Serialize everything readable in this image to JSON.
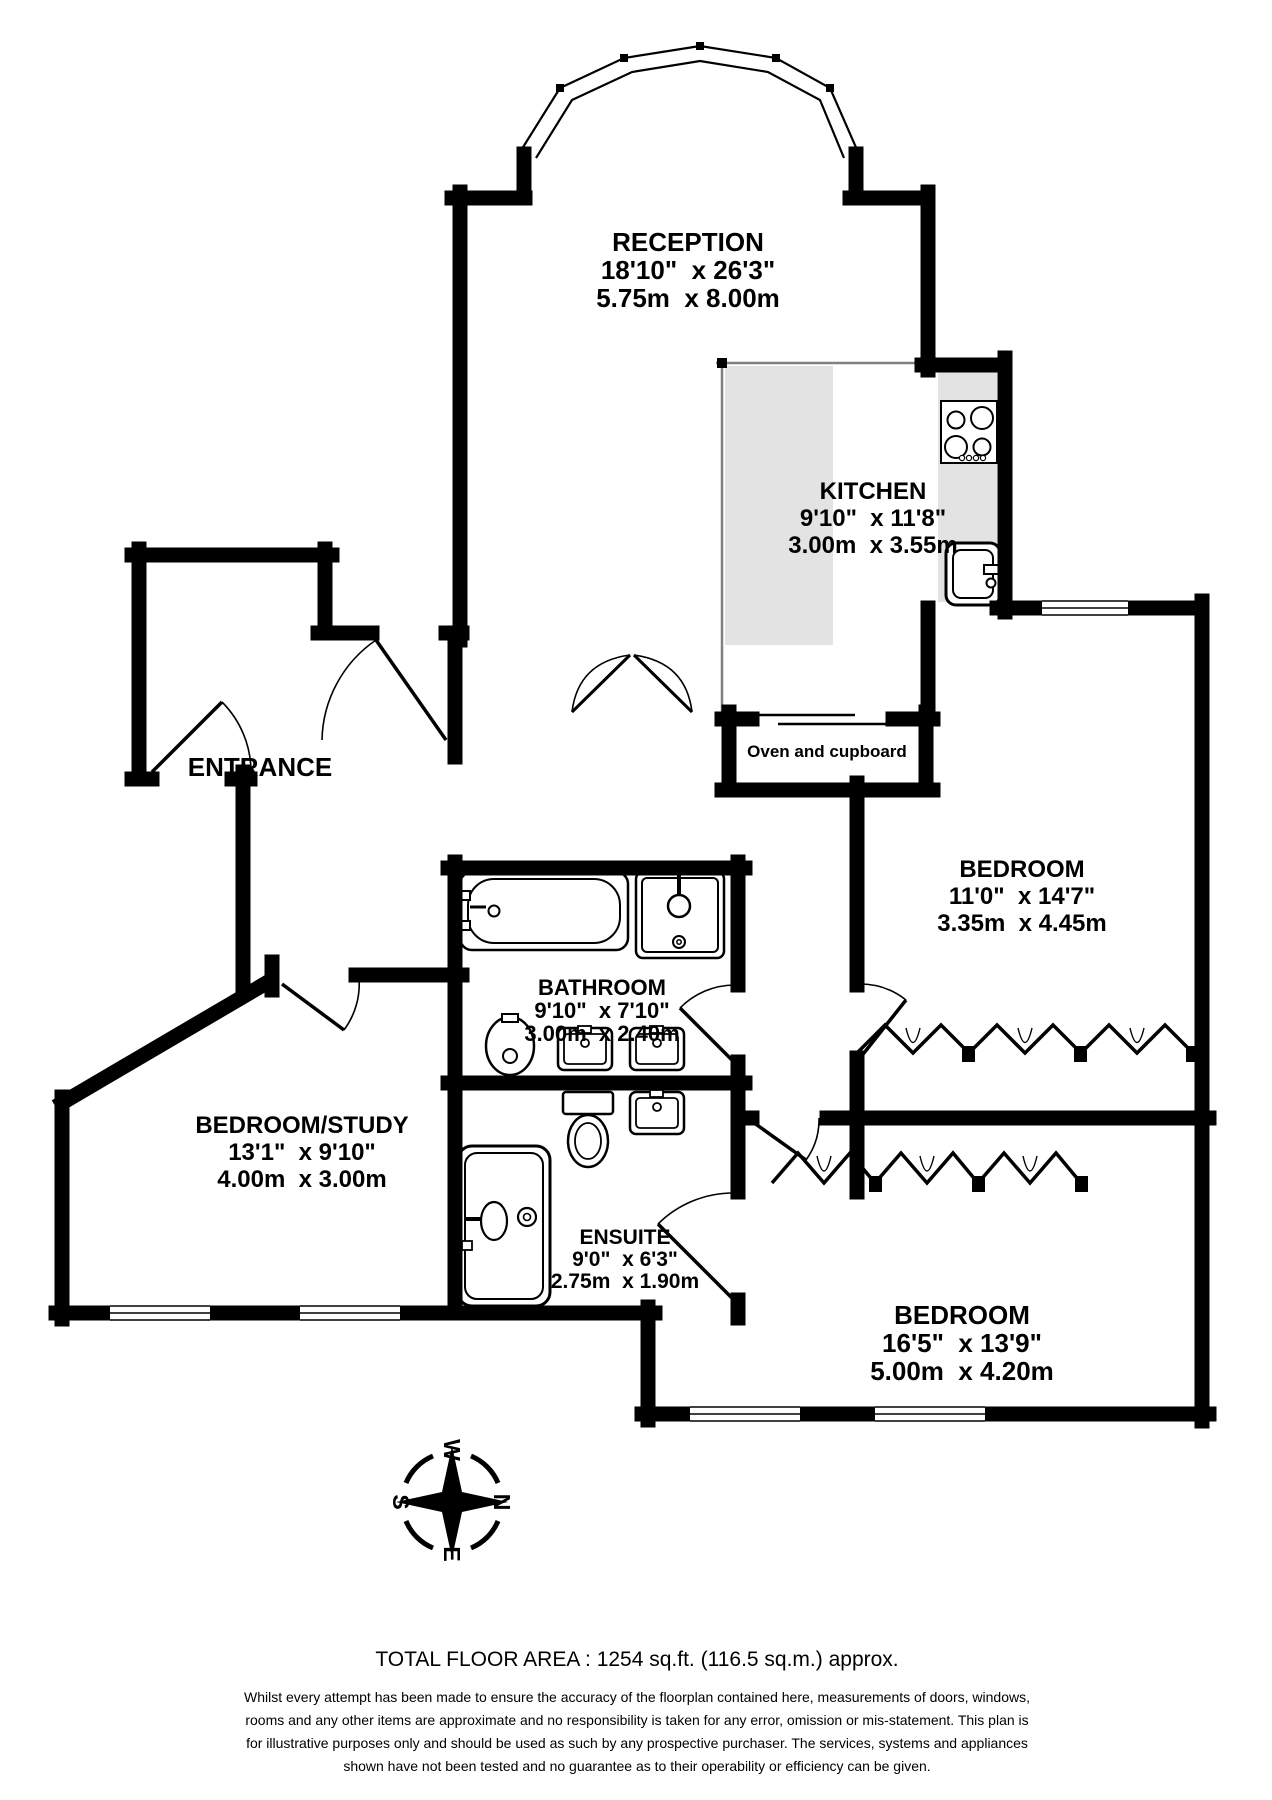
{
  "rooms": {
    "reception": {
      "name": "RECEPTION",
      "imperial": "18'10\"  x 26'3\"",
      "metric": "5.75m  x 8.00m"
    },
    "kitchen": {
      "name": "KITCHEN",
      "imperial": "9'10\"  x 11'8\"",
      "metric": "3.00m  x 3.55m"
    },
    "entrance": {
      "name": "ENTRANCE"
    },
    "bedroom1": {
      "name": "BEDROOM",
      "imperial": "11'0\"  x 14'7\"",
      "metric": "3.35m  x 4.45m"
    },
    "bathroom": {
      "name": "BATHROOM",
      "imperial": "9'10\"  x 7'10\"",
      "metric": "3.00m  x 2.40m"
    },
    "bedroom_study": {
      "name": "BEDROOM/STUDY",
      "imperial": "13'1\"  x 9'10\"",
      "metric": "4.00m  x 3.00m"
    },
    "ensuite": {
      "name": "ENSUITE",
      "imperial": "9'0\"  x 6'3\"",
      "metric": "2.75m  x 1.90m"
    },
    "bedroom2": {
      "name": "BEDROOM",
      "imperial": "16'5\"  x 13'9\"",
      "metric": "5.00m  x 4.20m"
    }
  },
  "annotations": {
    "oven_cupboard": "Oven and cupboard"
  },
  "compass": {
    "north": "N",
    "east": "E",
    "south": "S",
    "west": "W"
  },
  "footer": {
    "total_area": "TOTAL FLOOR AREA : 1254 sq.ft. (116.5 sq.m.) approx.",
    "disclaimer": "Whilst every attempt has been made to ensure the accuracy of the floorplan contained here, measurements of doors, windows, rooms and any other items are approximate and no responsibility is taken for any error, omission or mis-statement. This plan is for illustrative purposes only and should be used as such by any prospective purchaser. The services, systems and appliances shown have not been tested and no guarantee as to their operability or efficiency can be given."
  },
  "colors": {
    "wall": "#000000",
    "counter": "#e3e3e3",
    "background": "#ffffff"
  },
  "fixtures": [
    "hob-icon",
    "kitchen-sink-icon",
    "bathtub-icon",
    "shower-icon",
    "pedestal-sink-icon",
    "basin-icon",
    "toilet-icon",
    "ensuite-shower-icon",
    "wardrobe-bifold-icon",
    "compass-rose-icon",
    "bay-window-icon"
  ]
}
